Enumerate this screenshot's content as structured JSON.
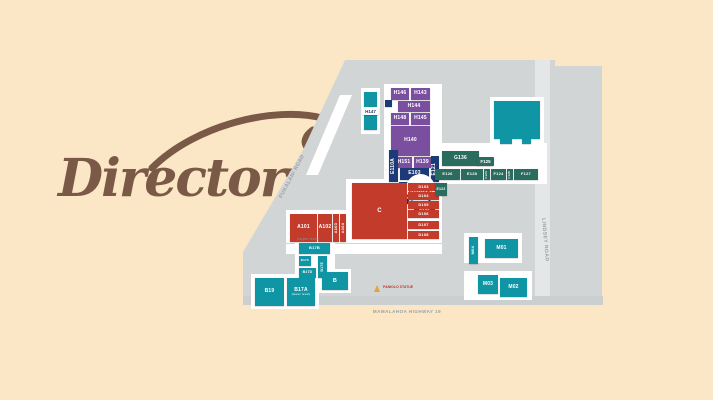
{
  "logo": {
    "title": "Directory"
  },
  "roads": {
    "pukalani": "PUKALANI ROAD",
    "mamalahoa": "MAMALAHOA HIGHWAY 19",
    "lindsey": "LINDSEY ROAD"
  },
  "annotations": {
    "h147": "H147",
    "f125": "F125",
    "e106": "E106",
    "upper": "(upper level)",
    "lower": "(lower level)",
    "statue": "PANIOLO STATUE"
  },
  "units": {
    "purple": {
      "h146": "H146",
      "h143": "H143",
      "h144": "H144",
      "h148": "H148",
      "h145": "H145",
      "h140": "H140",
      "h151": "H151",
      "h139": "H139"
    },
    "navy": {
      "e110a": "E110A",
      "e103": "E103",
      "e121": "E121",
      "e110": "E110",
      "e117": "E117",
      "e119": "E119",
      "e124": "E124",
      "food_court": "FOOD COURT"
    },
    "red": {
      "c": "C",
      "a101": "A101",
      "a102": "A102",
      "a103": "A103",
      "a104": "A104",
      "d103": "D103",
      "d104": "D104",
      "d105": "D105",
      "d106": "D106",
      "d107": "D107",
      "d108": "D108"
    },
    "green": {
      "g136": "G136",
      "e126": "E126",
      "e128": "E128",
      "f123": "F123",
      "f124": "F124",
      "f126": "F126",
      "f127": "F127",
      "e122": "E122"
    },
    "teal": {
      "i": "I",
      "b17b": "B17B",
      "b17c": "B17C",
      "b17d": "B17D",
      "b17e": "B17E",
      "b": "B",
      "b19": "B19",
      "b17a": "B17A",
      "m01": "M01",
      "m02": "M02",
      "m03": "M03",
      "m04": "M04"
    }
  },
  "colors": {
    "background": "#fbe7c6",
    "logo_brown": "#7a5a47",
    "red": "#c23b2b",
    "purple": "#7b4fa0",
    "navy": "#1d3a78",
    "teal": "#1095a5",
    "green": "#2a6c5e",
    "parking_gray": "#d2d5d6"
  }
}
